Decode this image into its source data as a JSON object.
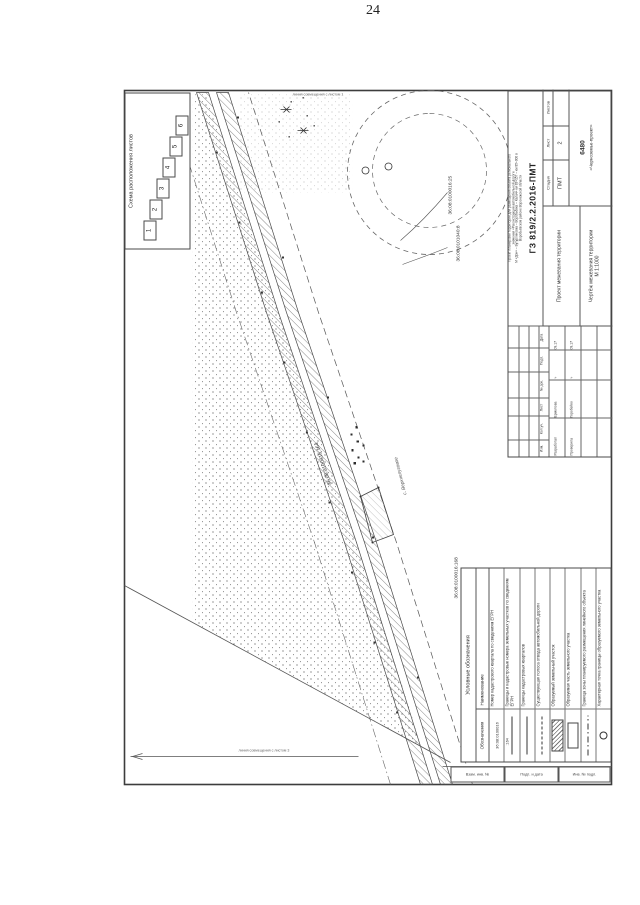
{
  "page": {
    "number": "24"
  },
  "sheet_scheme": {
    "title": "Схема расположения листов",
    "sheets": [
      "1",
      "2",
      "3",
      "4",
      "5",
      "6"
    ]
  },
  "map": {
    "labels": {
      "road_parcel": "36:08:0100016:164",
      "parcel_right_1": "36:08:0100016:25",
      "parcel_right_2": "36:08:0101040:8",
      "quarter_near_legend": "36:08:0100016:168",
      "settlement": "с. Верхнелуговое",
      "match_line_left": "линия совмещения с листом 3",
      "match_line_right": "линия совмещения с листом 1"
    }
  },
  "legend": {
    "title": "Условные обозначения",
    "columns": {
      "symbol": "Обозначения",
      "name": "Наименование"
    },
    "rows": [
      {
        "symbol": "cadastral-number",
        "sample": "36:08:0100016",
        "name": "Номер кадастрового квартала по сведениям ЕГРН"
      },
      {
        "symbol": "line-number",
        "sample": ":164",
        "name": "Границы и кадастровые номера земельных участков по сведениям ЕГРН"
      },
      {
        "symbol": "solid-line",
        "sample": "",
        "name": "Границы кадастровых кварталов"
      },
      {
        "symbol": "dashed-line",
        "sample": "",
        "name": "Существующая полоса отвода автомобильной дороги"
      },
      {
        "symbol": "hatched-rect",
        "sample": "",
        "name": "Образуемый земельный участок"
      },
      {
        "symbol": "rect",
        "sample": "",
        "name": "Образуемая часть земельного участка"
      },
      {
        "symbol": "dash-dot-line",
        "sample": "",
        "name": "Граница зоны планируемого размещения линейного объекта"
      },
      {
        "symbol": "circle",
        "sample": "",
        "name": "Характерная точка границы образуемого земельного участка"
      }
    ]
  },
  "title_block": {
    "description_lines": [
      "Проект планировки территории для размещения объекта регионального",
      "значения «Реконструкция автомобильной дороги",
      "М «Дон» – Бутурлиновка – Воробьёвка – Калач» км 83+157 – км 85+000 в",
      "Воробьёвском районе Воронежской области"
    ],
    "doc_code": "ГЗ 819/2.2.2016-ПМТ",
    "project_title": "Проект межевания территории",
    "sheet_title": "Чертёж межевания территории",
    "sheet_scale": "М 1:1000",
    "stage_label": "Стадия",
    "sheet_label": "Лист",
    "sheets_label": "Листов",
    "stage_value": "ПМТ",
    "sheet_value": "2",
    "sheets_value": "",
    "org_code": "6480",
    "org_name": "«Черноземье-проект»",
    "revision_headers": [
      "Изм.",
      "Кол.уч.",
      "Лист",
      "№ док.",
      "Подп.",
      "Дата"
    ],
    "signatures": [
      {
        "role": "Разработал",
        "name": "Ермолова",
        "sign": "∿",
        "date": "09.17"
      },
      {
        "role": "Проверила",
        "name": "Горобейко",
        "sign": "∿",
        "date": "09.17"
      }
    ]
  },
  "margin_strip": {
    "cells": [
      "Взам. инв. №",
      "Подп. и дата",
      "Инв. № подл."
    ]
  }
}
